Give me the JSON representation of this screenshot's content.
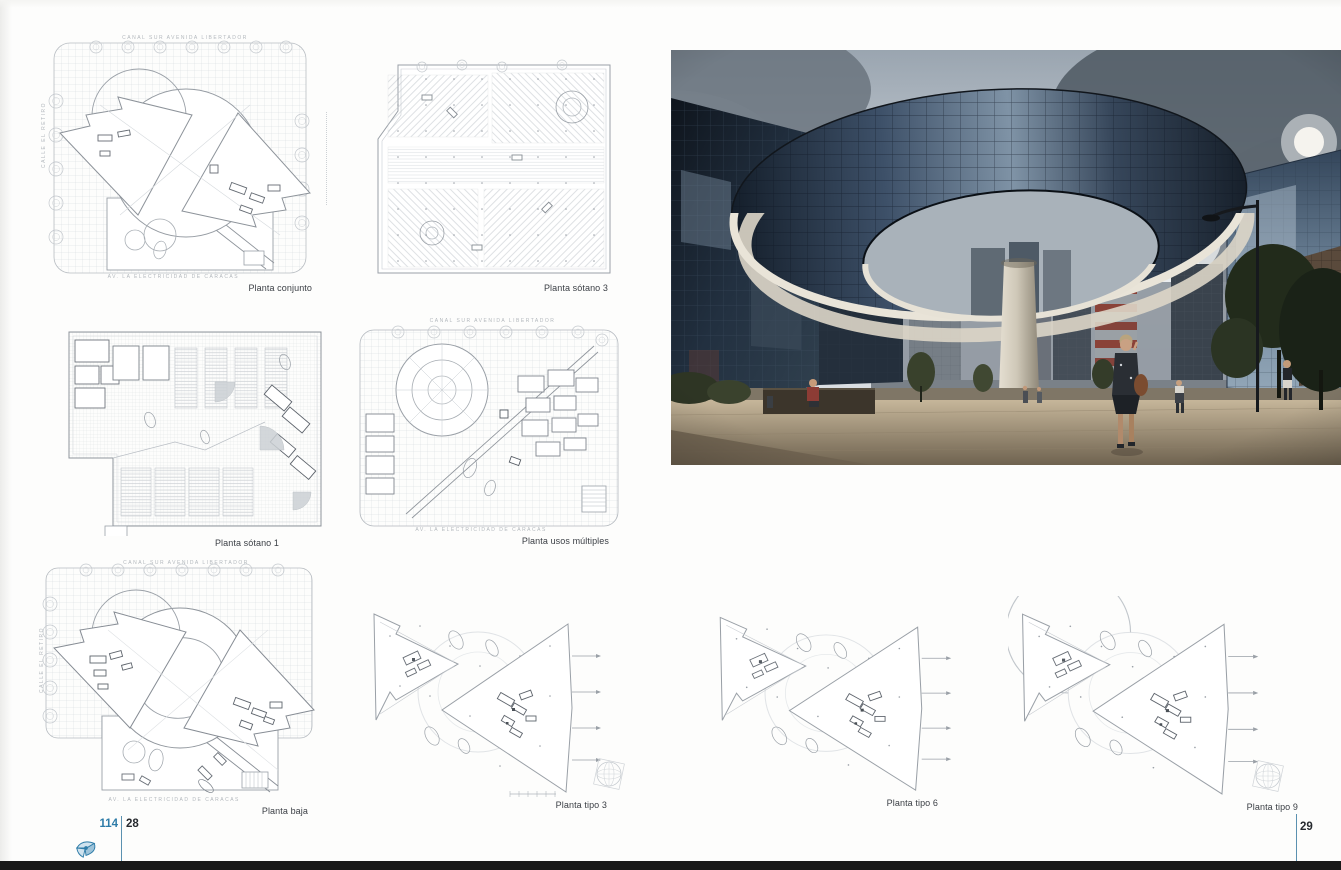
{
  "folio": {
    "left": {
      "book_number": "114",
      "page_number": "28"
    },
    "right": {
      "page_number": "29"
    }
  },
  "colors": {
    "accent_blue": "#2e7ca8",
    "bottom_bar": "#191919",
    "caption_text": "#3a3e44"
  },
  "left_page": {
    "plans": [
      {
        "id": "planta-conjunto",
        "caption": "Planta conjunto"
      },
      {
        "id": "planta-sotano-3",
        "caption": "Planta sótano 3"
      },
      {
        "id": "planta-sotano-1",
        "caption": "Planta sótano 1"
      },
      {
        "id": "planta-usos-multiples",
        "caption": "Planta usos múltiples"
      },
      {
        "id": "planta-baja",
        "caption": "Planta baja"
      },
      {
        "id": "planta-tipo-3",
        "caption": "Planta tipo 3"
      }
    ],
    "street_labels": {
      "top": "CANAL SUR AVENIDA LIBERTADOR",
      "left": "CALLE EL RETIRO",
      "bottom": "AV. LA ELECTRICIDAD DE CARACAS"
    }
  },
  "right_page": {
    "plans": [
      {
        "id": "planta-tipo-6",
        "caption": "Planta tipo 6"
      },
      {
        "id": "planta-tipo-9",
        "caption": "Planta tipo 9"
      }
    ]
  }
}
